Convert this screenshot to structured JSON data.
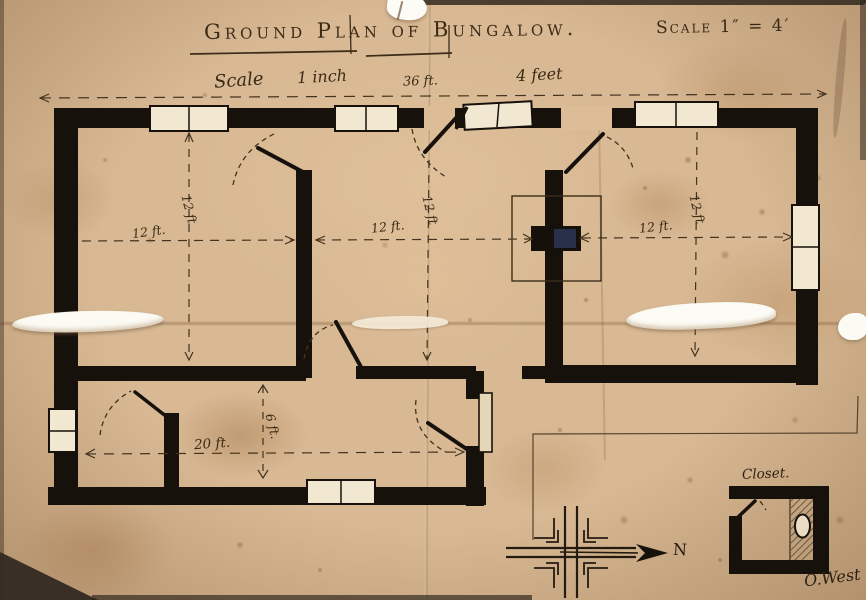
{
  "document": {
    "type": "hand-drawn architectural floor plan",
    "title_main": "Ground Plan of Bungalow.",
    "title_scale": "Scale 1″ = 4′",
    "signature": "O.West"
  },
  "scale_bar": {
    "word_scale": "Scale",
    "word_inch": "1 inch",
    "total_width": "36 ft.",
    "word_feet": "4 feet"
  },
  "dimensions": {
    "room1_width": "12 ft.",
    "room1_depth": "12 ft",
    "room2_width": "12 ft.",
    "room2_depth": "12 ft",
    "room3_width": "12 ft.",
    "room3_depth": "12 ft",
    "hall_width": "20 ft.",
    "hall_depth": "6 ft."
  },
  "closet": {
    "label": "Closet."
  },
  "compass": {
    "north": "N"
  },
  "colors": {
    "paper": "#d8b994",
    "ink": "#16110b",
    "blue_ink_patch": "#2a3350",
    "tear_white": "#fbfaf3"
  }
}
